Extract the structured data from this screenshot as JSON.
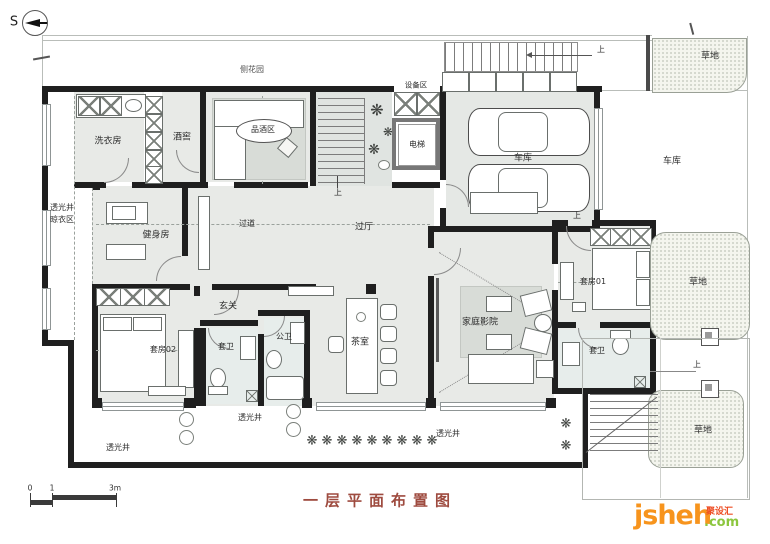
{
  "title": {
    "text": "一层平面布置图"
  },
  "compass": {
    "label": "S"
  },
  "scalebar": {
    "zero": "0",
    "one": "1",
    "three": "3m"
  },
  "watermark": {
    "brand": "jsheh",
    "tld": ".com",
    "cn": "聚设汇"
  },
  "rooms": {
    "side_garden": "侧花园",
    "laundry": "洗衣房",
    "wine_cellar": "酒窖",
    "wine_tasting": "品酒区",
    "equipment": "设备区",
    "elevator": "电梯",
    "garage": "车库",
    "garage_outdoor": "车库",
    "gym": "健身房",
    "corridor": "过道",
    "hall": "过厅",
    "foyer": "玄关",
    "suite02": "套房02",
    "suite_bath": "套卫",
    "public_bath": "公卫",
    "tea_room": "茶室",
    "home_theater": "家庭影院",
    "suite01": "套房01",
    "lawn": "草地",
    "lightwell": "透光井",
    "drying_area": "晾衣区",
    "up": "上"
  },
  "glyphs": {
    "flower": "❋"
  },
  "colors": {
    "wall": "#1f1f1f",
    "floor": "#e8eae7",
    "rug": "#d8dcd7",
    "lawn_bg": "#f4f5ee",
    "title": "#9e4b3f",
    "brand_orange": "#f7941d",
    "brand_green": "#8cc63e",
    "brand_red": "#ee4d23"
  }
}
